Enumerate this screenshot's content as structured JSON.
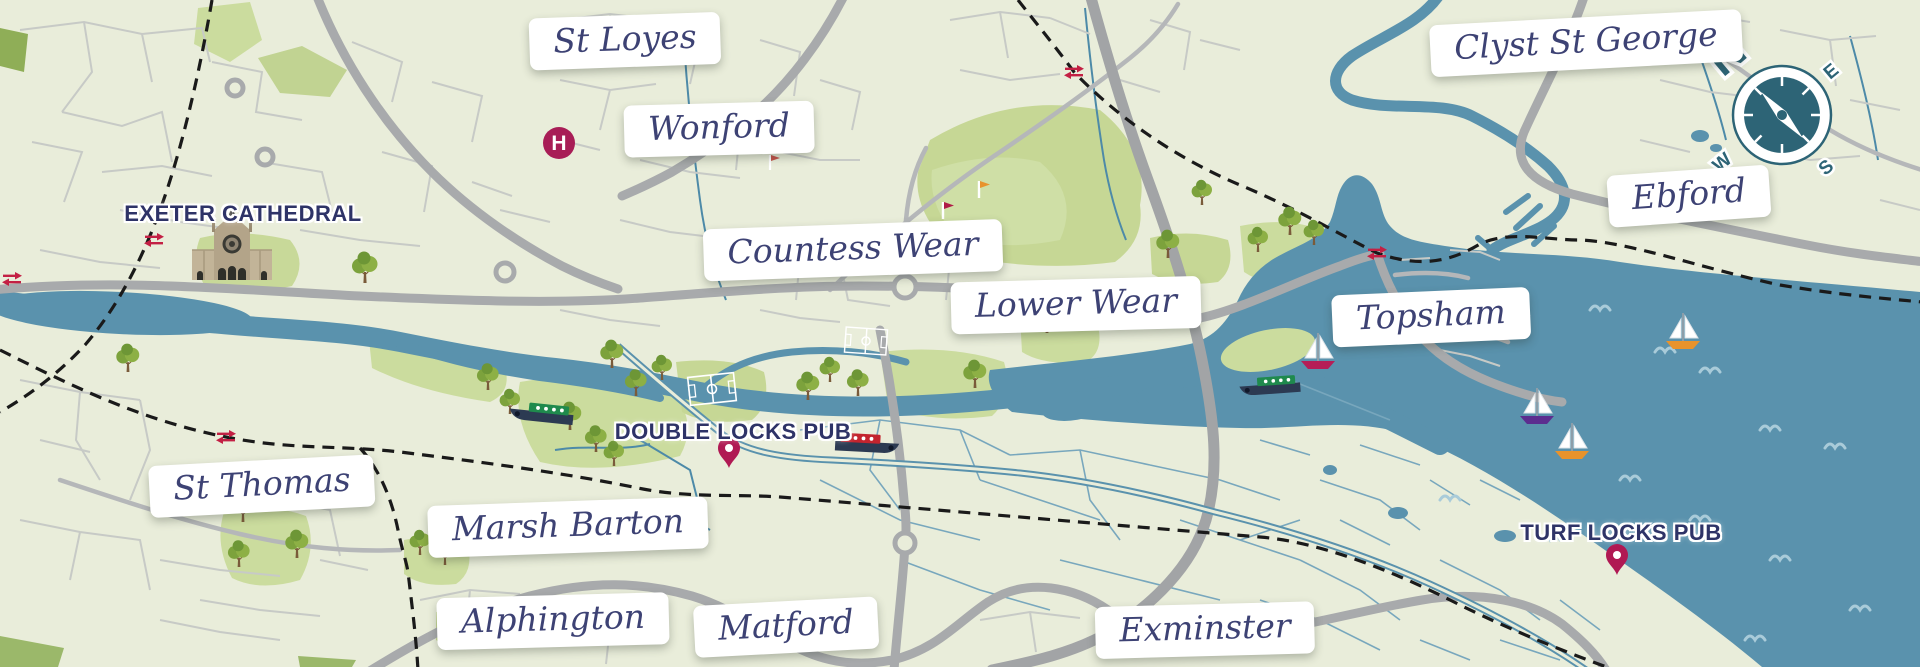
{
  "map": {
    "region_labels": [
      {
        "name": "st-loyes",
        "text": "St Loyes"
      },
      {
        "name": "wonford",
        "text": "Wonford"
      },
      {
        "name": "clyst-st-george",
        "text": "Clyst St George"
      },
      {
        "name": "ebford",
        "text": "Ebford"
      },
      {
        "name": "countess-wear",
        "text": "Countess Wear"
      },
      {
        "name": "lower-wear",
        "text": "Lower Wear"
      },
      {
        "name": "topsham",
        "text": "Topsham"
      },
      {
        "name": "st-thomas",
        "text": "St Thomas"
      },
      {
        "name": "marsh-barton",
        "text": "Marsh Barton"
      },
      {
        "name": "alphington",
        "text": "Alphington"
      },
      {
        "name": "matford",
        "text": "Matford"
      },
      {
        "name": "exminster",
        "text": "Exminster"
      }
    ],
    "poi_labels": [
      {
        "name": "exeter-cathedral",
        "text": "EXETER CATHEDRAL"
      },
      {
        "name": "double-locks-pub",
        "text": "DOUBLE LOCKS PUB"
      },
      {
        "name": "turf-locks-pub",
        "text": "TURF LOCKS PUB"
      }
    ],
    "compass": {
      "north": "N",
      "east": "E",
      "west": "W",
      "south": "S"
    },
    "hospital_marker": "H",
    "icons": [
      "compass-rose-icon",
      "hospital-icon",
      "cathedral-icon",
      "rail-station-icon",
      "map-pin-icon",
      "narrowboat-icon",
      "sailboat-icon",
      "tree-icon",
      "golf-flag-icon",
      "wave-icon",
      "football-pitch-icon"
    ],
    "colors": {
      "land": "#e9edda",
      "water": "#5a92ad",
      "park": "#cbdc9e",
      "road_major": "#a8aaac",
      "road_minor": "#c7cac6",
      "railway": "#1a1a1a",
      "label_text": "#3d4274",
      "poi_text": "#2e3367",
      "pin": "#b01953",
      "compass": "#2d6476",
      "hospital": "#a81d56",
      "tree": "#7ca23c",
      "boat_hull": "#2c3a52",
      "boat_green": "#1f8a4d",
      "boat_red": "#c3242e",
      "sail_hull_red": "#b51e57",
      "sail_hull_purple": "#5c2d8f",
      "sail_hull_orange": "#e8932c"
    }
  }
}
